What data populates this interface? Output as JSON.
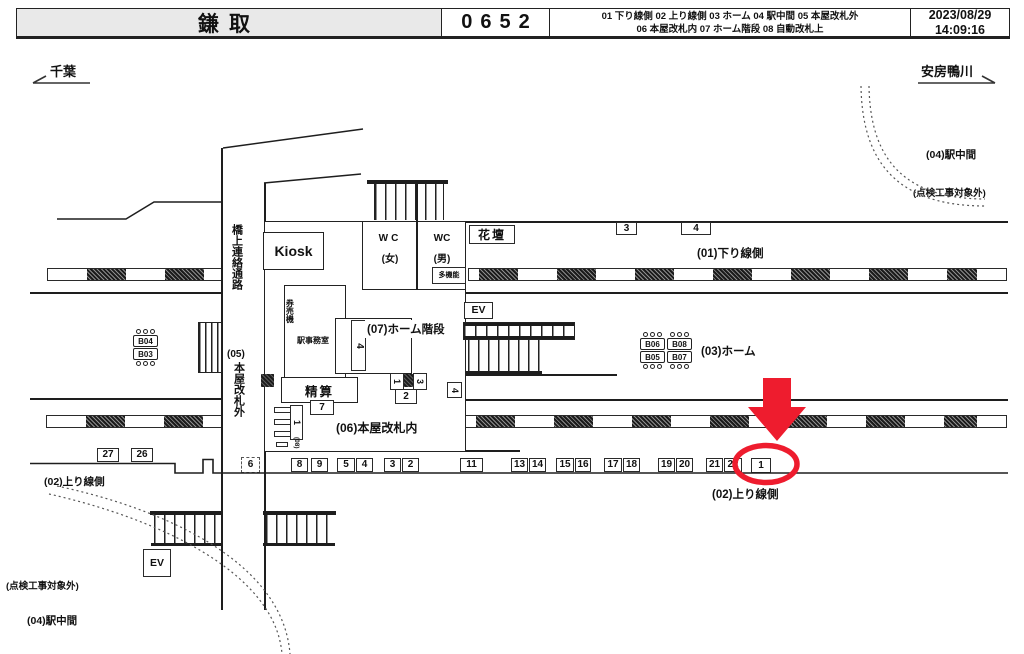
{
  "header": {
    "station": "鎌取",
    "code": "0652",
    "legend1": "01 下り線側   02 上り線側   03 ホーム   04 駅中間   05 本屋改札外",
    "legend2": "06 本屋改札内   07 ホーム階段   08 自動改札上",
    "date": "2023/08/29",
    "time": "14:09:16"
  },
  "directions": {
    "left": "千葉",
    "right": "安房鴨川"
  },
  "areas": {
    "down_line": "(01)下り線側",
    "up_line_left": "(02)上り線側",
    "up_line_right": "(02)上り線側",
    "platform": "(03)ホーム",
    "mid_tr": "(04)駅中間",
    "mid_bl": "(04)駅中間",
    "excl_tr": "(点検工事対象外)",
    "excl_bl": "(点検工事対象外)",
    "inside_gate": "(06)本屋改札内",
    "platform_stairs": "(07)ホーム階段"
  },
  "corridor": {
    "bridge": "橋上連絡通路",
    "outside_prefix": "(05)",
    "outside_main": "本屋改札外"
  },
  "rooms": {
    "kiosk": "Kiosk",
    "wc_label_w": "WC",
    "wc_w": "(女)",
    "wc_label_m": "WC",
    "wc_m": "(男)",
    "multifunction": "多機能",
    "flowerbed": "花壇",
    "ev_platform": "EV",
    "ev_bridge": "EV",
    "ticket_machines": "券売機",
    "office": "駅事務室",
    "fare_adjustment": "精算"
  },
  "gates": {
    "category": "(08)",
    "top_number": "1"
  },
  "positions": {
    "down": [
      "3",
      "4"
    ],
    "up_left": [
      "27",
      "26"
    ],
    "gate_dashed": "6",
    "inside_row": [
      "8",
      "9",
      "5",
      "4",
      "3",
      "2"
    ],
    "box11": "11",
    "row_right": [
      "13",
      "14",
      "15",
      "16",
      "17",
      "18",
      "19",
      "20",
      "21",
      "22"
    ],
    "highlighted": "1",
    "box7": "7",
    "stair4": "4",
    "rot1": "1",
    "rot3": "3",
    "box2": "2",
    "rot4": "4"
  },
  "benches": {
    "left": [
      "B04",
      "B03"
    ],
    "mid1": [
      "B06",
      "B05"
    ],
    "mid2": [
      "B08",
      "B07"
    ]
  },
  "colors": {
    "accent_red": "#ee1c2e",
    "header_bg": "#e9e9e9",
    "line": "#1e1e1e"
  }
}
